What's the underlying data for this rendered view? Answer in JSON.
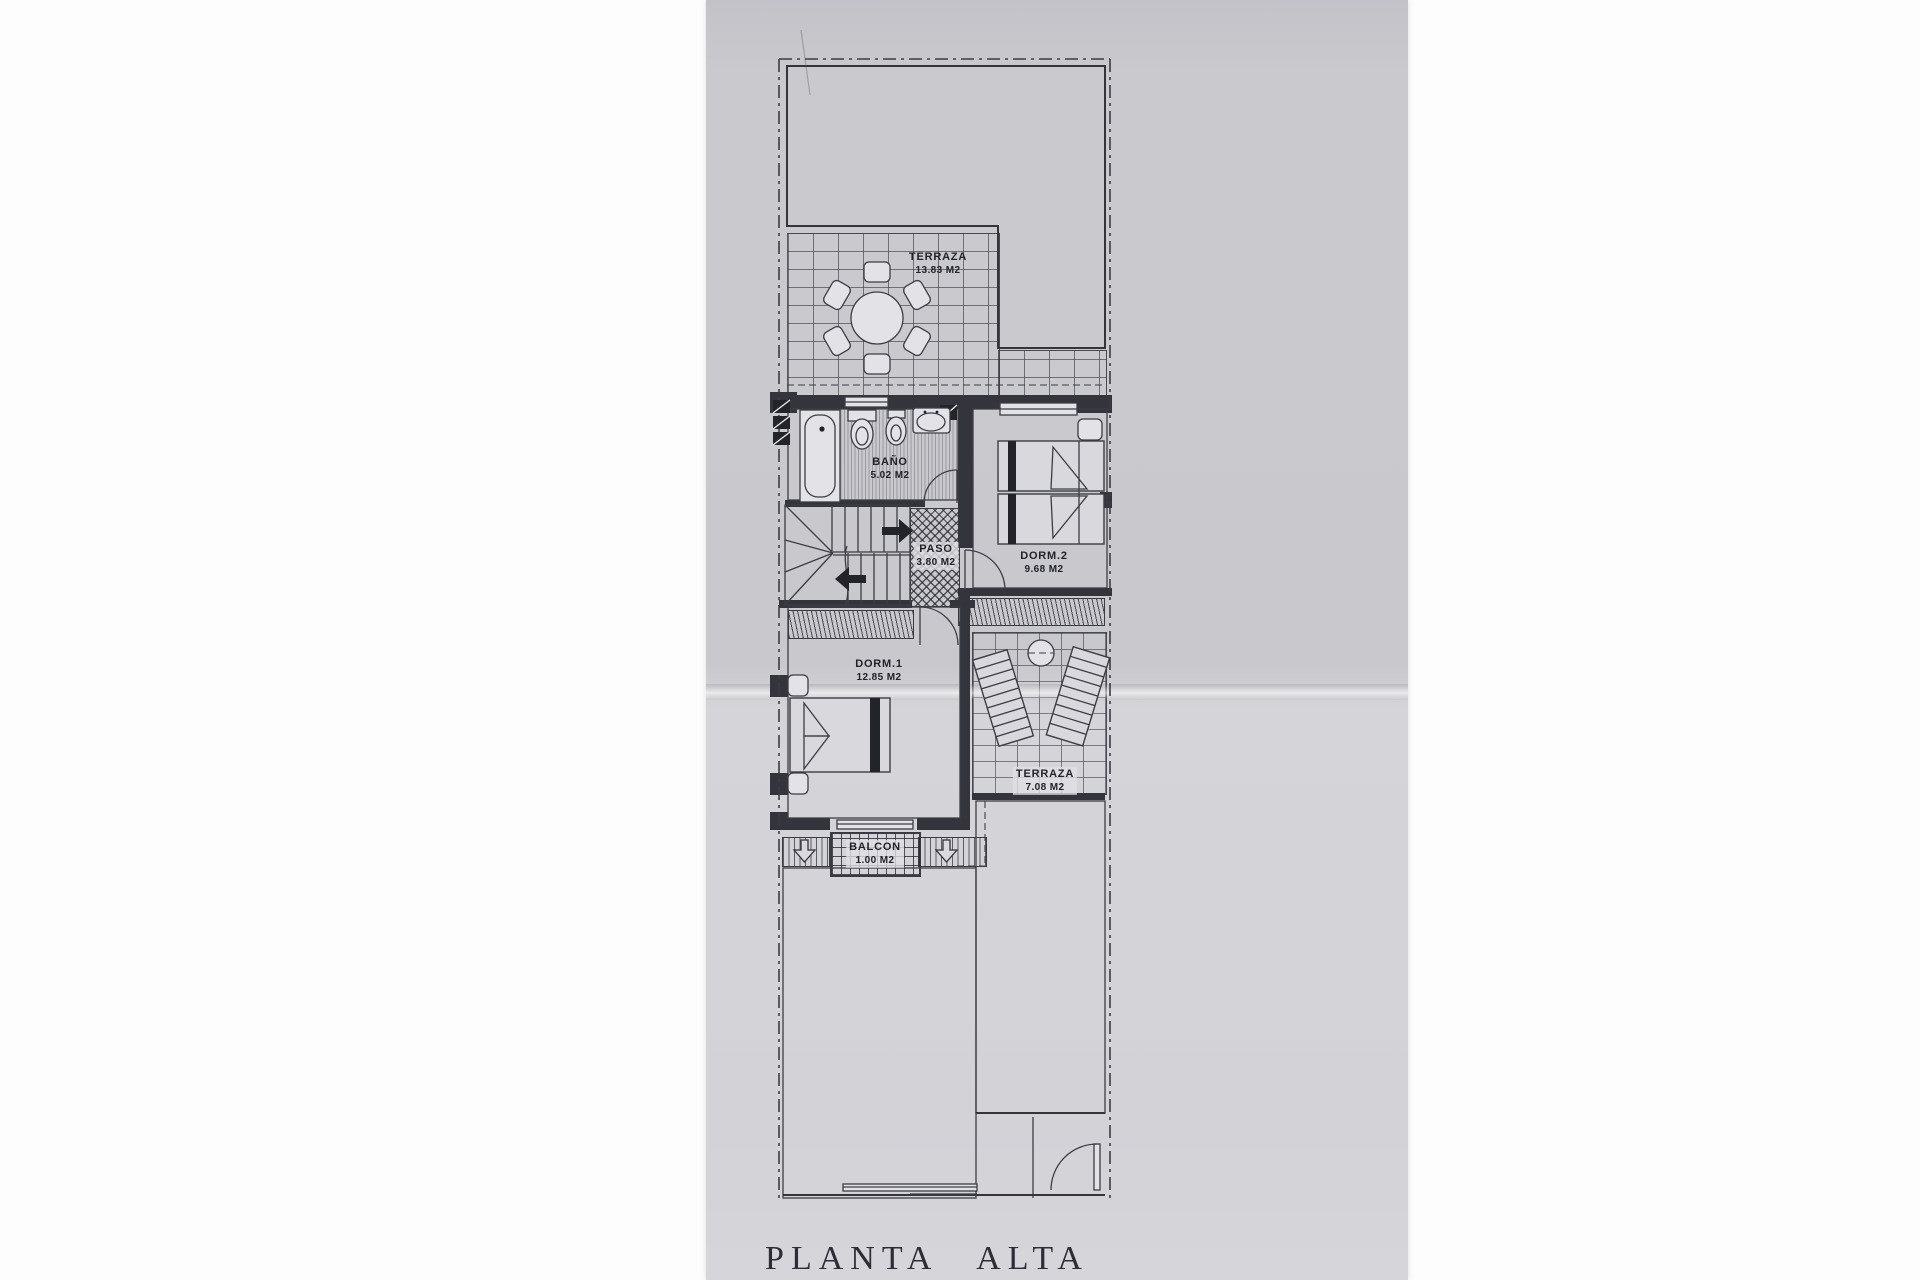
{
  "document": {
    "title": "PLANTA ALTA"
  },
  "rooms": [
    {
      "name": "TERRAZA",
      "area": "13.83 M2"
    },
    {
      "name": "BAÑO",
      "area": "5.02 M2"
    },
    {
      "name": "PASO",
      "area": "3.80 M2"
    },
    {
      "name": "DORM.2",
      "area": "9.68 M2"
    },
    {
      "name": "DORM.1",
      "area": "12.85 M2"
    },
    {
      "name": "TERRAZA",
      "area": "7.08 M2"
    },
    {
      "name": "BALCON",
      "area": "1.00 M2"
    }
  ],
  "colors": {
    "paper": "#c9c9ce",
    "ink": "#3c3c44",
    "wall": "#34343c"
  }
}
